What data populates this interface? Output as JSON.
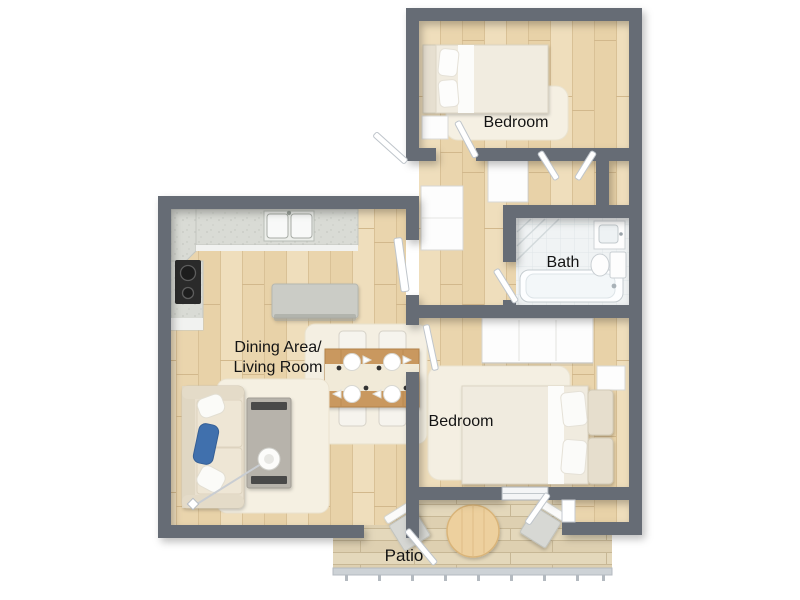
{
  "labels": {
    "bedroom_top": "Bedroom",
    "bath": "Bath",
    "living_line1": "Dining Area/",
    "living_line2": "Living Room",
    "bedroom_bottom": "Bedroom",
    "patio": "Patio"
  },
  "colors": {
    "wall": "#666c74",
    "wood_floor": "#ecd9b3",
    "plank_line": "#d9c196",
    "deck": "#e4d8bb",
    "bath_tile": "#f0f3f4",
    "rug": "#f4efe2",
    "counter": "#d9dbd5",
    "island": "#cbccc6",
    "sofa": "#e9e0cf",
    "accent_pillow_blue": "#4070ad",
    "dining_table_wood": "#c9985e",
    "patio_table_wood": "#edd09e",
    "cooktop": "#2a2a2a",
    "label_text": "#141414",
    "background": "#ffffff"
  },
  "furniture": [
    "bed",
    "nightstand",
    "wardrobe",
    "closet",
    "bathtub",
    "toilet",
    "vanity-sink",
    "kitchen-counter",
    "cooktop",
    "double-sink",
    "kitchen-island",
    "dining-table",
    "dining-chair",
    "sofa",
    "coffee-table",
    "floor-lamp",
    "area-rug",
    "patio-table",
    "patio-chair",
    "railing",
    "door-leaf"
  ]
}
